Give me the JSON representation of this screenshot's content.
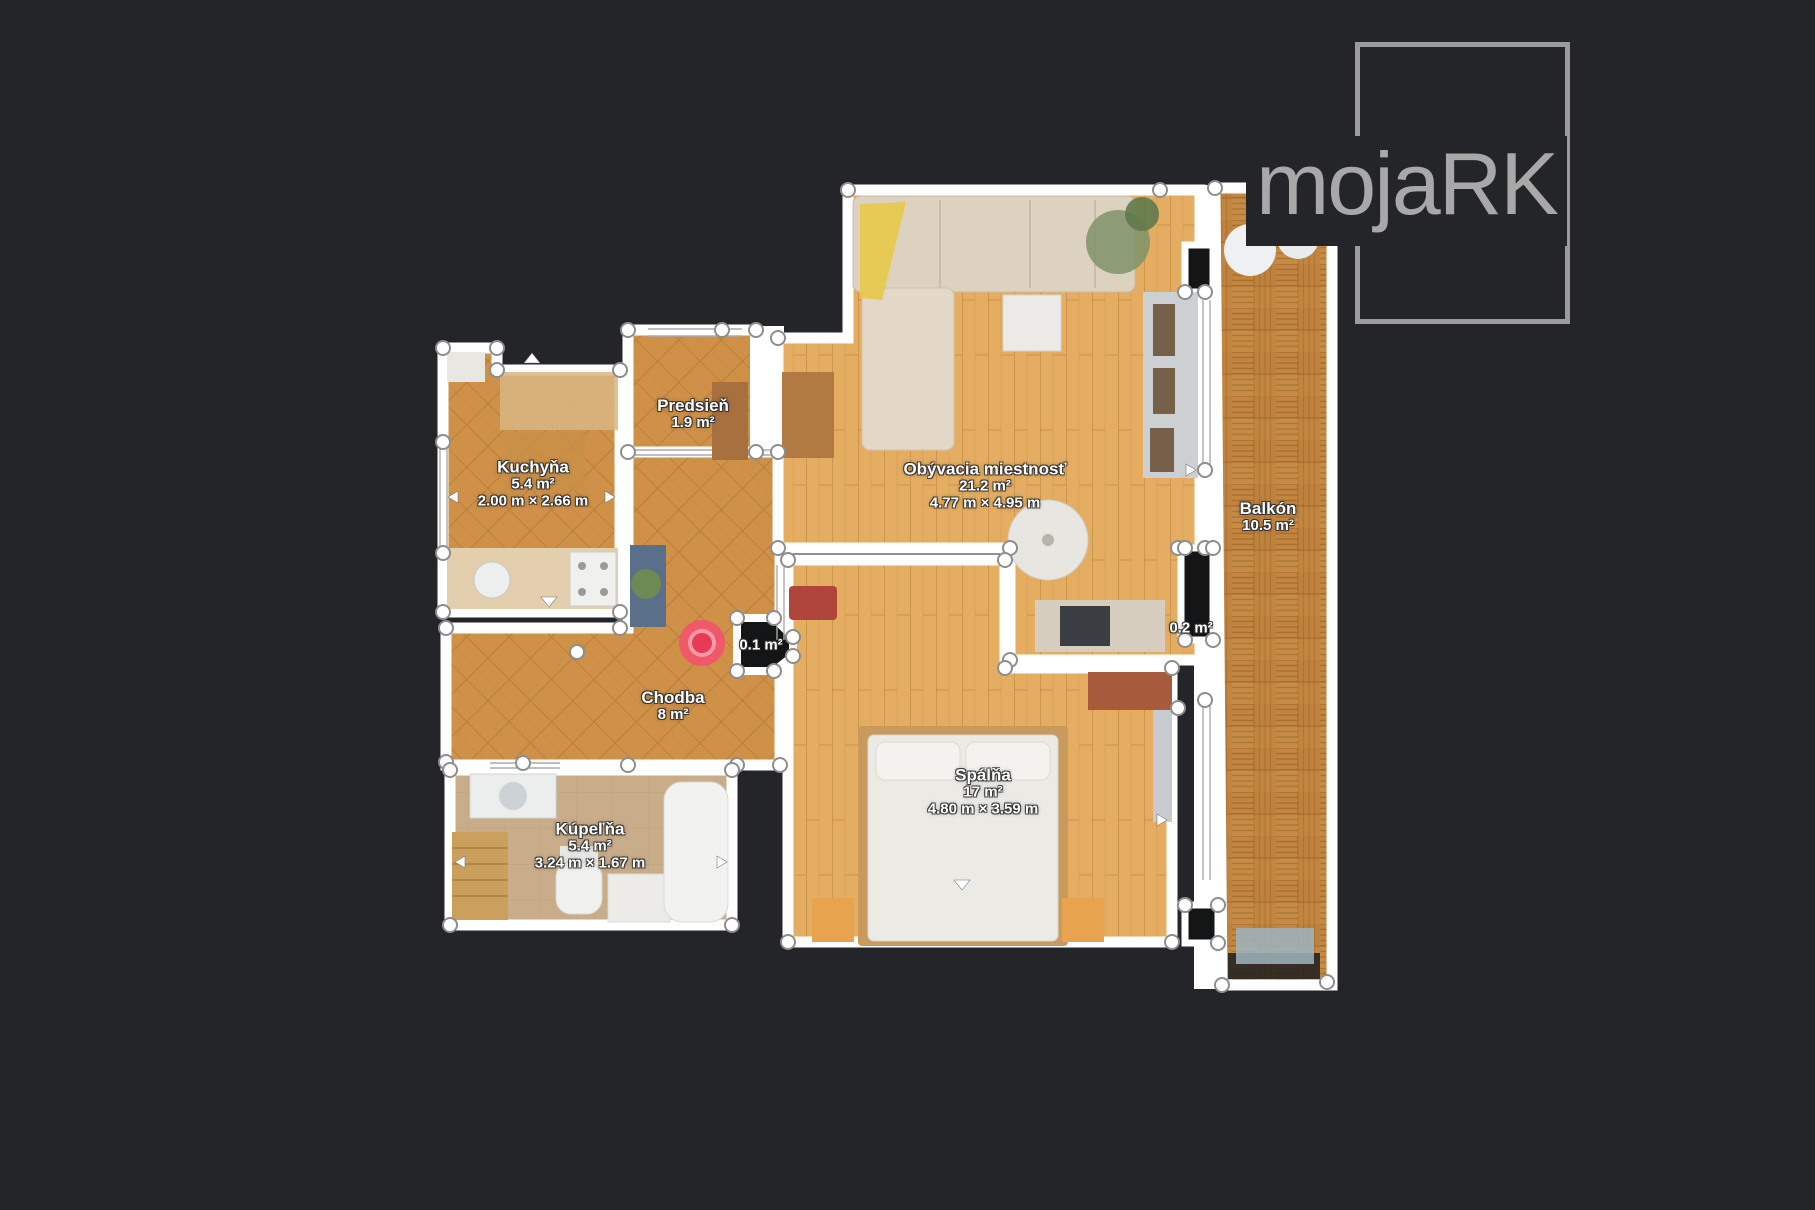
{
  "page": {
    "background_color": "#242529",
    "type": "apartment-floor-plan"
  },
  "logo": {
    "text": "mojaRK",
    "text_color": "#a8a8a9",
    "frame_color": "#9b9b9c"
  },
  "marker": {
    "description": "scan-position-target",
    "outer_color": "#f0566b",
    "mid_color": "#f59aa7",
    "inner_color": "#e83a55"
  },
  "palette": {
    "wall": "#ffffff",
    "tile_floor": "#cf9148",
    "plank_floor": "#e5ad61",
    "parquet_floor": "#c28640",
    "bath_floor": "#c9ad8a",
    "void": "#141517"
  },
  "rooms": [
    {
      "id": "kuchyna",
      "name": "Kuchyňa",
      "area": "5.4 m²",
      "dims": "2.00 m × 2.66 m"
    },
    {
      "id": "predsien",
      "name": "Predsieň",
      "area": "1.9 m²",
      "dims": ""
    },
    {
      "id": "obyvacia",
      "name": "Obývacia miestnosť",
      "area": "21.2 m²",
      "dims": "4.77 m × 4.95 m"
    },
    {
      "id": "balkon",
      "name": "Balkón",
      "area": "10.5 m²",
      "dims": ""
    },
    {
      "id": "chodba",
      "name": "Chodba",
      "area": "8 m²",
      "dims": ""
    },
    {
      "id": "spalna",
      "name": "Spálňa",
      "area": "17 m²",
      "dims": "4.80 m × 3.59 m"
    },
    {
      "id": "kupelna",
      "name": "Kúpeľňa",
      "area": "5.4 m²",
      "dims": "3.24 m × 1.67 m"
    },
    {
      "id": "shaft-small",
      "name": "",
      "area": "0.1 m²",
      "dims": ""
    },
    {
      "id": "shaft-big",
      "name": "",
      "area": "0.2 m²",
      "dims": ""
    }
  ]
}
